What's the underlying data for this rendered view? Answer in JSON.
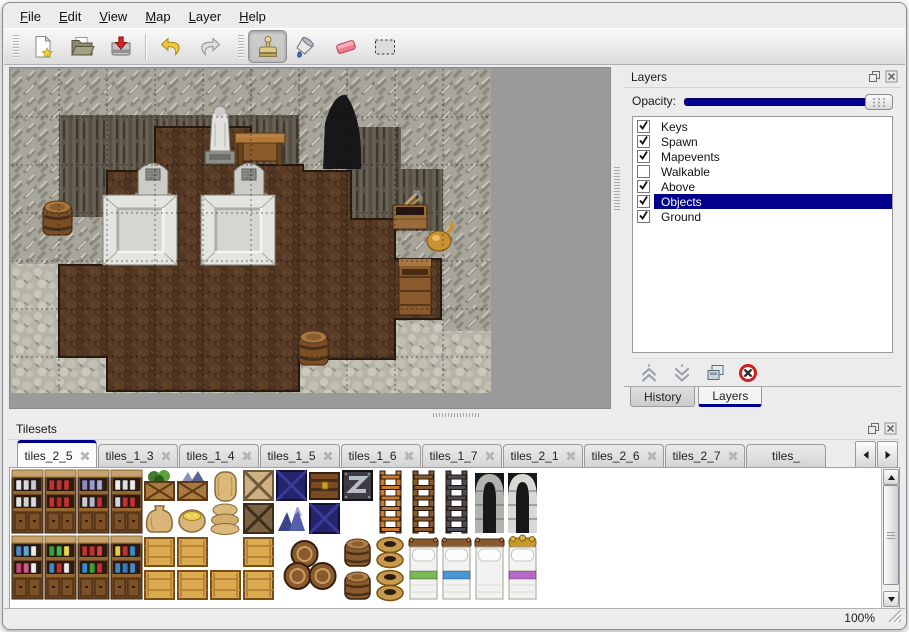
{
  "menu": {
    "items": [
      {
        "label": "File",
        "mnemonic": 0
      },
      {
        "label": "Edit",
        "mnemonic": 0
      },
      {
        "label": "View",
        "mnemonic": 0
      },
      {
        "label": "Map",
        "mnemonic": 0
      },
      {
        "label": "Layer",
        "mnemonic": 0
      },
      {
        "label": "Help",
        "mnemonic": 0
      }
    ]
  },
  "toolbar": {
    "tools": [
      {
        "name": "new-file",
        "active": false
      },
      {
        "name": "open",
        "active": false
      },
      {
        "name": "save",
        "active": false
      },
      {
        "name": "sep",
        "active": false
      },
      {
        "name": "undo",
        "active": false
      },
      {
        "name": "redo",
        "active": false
      },
      {
        "name": "grip",
        "active": false
      },
      {
        "name": "stamp",
        "active": true
      },
      {
        "name": "fill",
        "active": false
      },
      {
        "name": "eraser",
        "active": false
      },
      {
        "name": "select-rect",
        "active": false
      }
    ]
  },
  "layers_panel": {
    "title": "Layers",
    "opacity_label": "Opacity:",
    "layers": [
      {
        "name": "Keys",
        "checked": true,
        "selected": false
      },
      {
        "name": "Spawn",
        "checked": true,
        "selected": false
      },
      {
        "name": "Mapevents",
        "checked": true,
        "selected": false
      },
      {
        "name": "Walkable",
        "checked": false,
        "selected": false
      },
      {
        "name": "Above",
        "checked": true,
        "selected": false
      },
      {
        "name": "Objects",
        "checked": true,
        "selected": true
      },
      {
        "name": "Ground",
        "checked": true,
        "selected": false
      }
    ],
    "buttons": [
      "raise-layer",
      "lower-layer",
      "duplicate-layer",
      "delete-layer"
    ],
    "tabs": [
      {
        "label": "History",
        "active": false
      },
      {
        "label": "Layers",
        "active": true
      }
    ]
  },
  "tilesets_panel": {
    "title": "Tilesets",
    "tabs": [
      {
        "label": "tiles_2_5",
        "active": true
      },
      {
        "label": "tiles_1_3",
        "active": false
      },
      {
        "label": "tiles_1_4",
        "active": false
      },
      {
        "label": "tiles_1_5",
        "active": false
      },
      {
        "label": "tiles_1_6",
        "active": false
      },
      {
        "label": "tiles_1_7",
        "active": false
      },
      {
        "label": "tiles_2_1",
        "active": false
      },
      {
        "label": "tiles_2_6",
        "active": false
      },
      {
        "label": "tiles_2_7",
        "active": false
      },
      {
        "label": "tiles_",
        "active": false,
        "partial": true
      }
    ],
    "tiles": [
      {
        "t": "shelf",
        "c": 0,
        "r": 0,
        "top": [
          "#e6e6ea",
          "#d8d8e4",
          "#c9c9da"
        ],
        "bot": [
          "#e2e2e2",
          "#cfcfcf",
          "#dadae4"
        ]
      },
      {
        "t": "shelf",
        "c": 1,
        "r": 0,
        "top": [
          "#c23232",
          "#c23232",
          "#c23232"
        ],
        "bot": [
          "#c23232",
          "#b22a2a",
          "#c23232"
        ]
      },
      {
        "t": "shelf",
        "c": 2,
        "r": 0,
        "top": [
          "#8a8ac4",
          "#9a9ad2",
          "#aaaadc"
        ],
        "bot": [
          "#cacade",
          "#b8b8cc",
          "#c23232"
        ]
      },
      {
        "t": "shelf",
        "c": 3,
        "r": 0,
        "top": [
          "#ececec",
          "#dcdcdc",
          "#ececec"
        ],
        "bot": [
          "#d2d2e4",
          "#c23232",
          "#c23232"
        ]
      },
      {
        "t": "crate_plant",
        "c": 4,
        "r": 0
      },
      {
        "t": "crate_ore",
        "c": 5,
        "r": 0
      },
      {
        "t": "sack_tall",
        "c": 6,
        "r": 0
      },
      {
        "t": "cratex",
        "c": 7,
        "r": 0,
        "v": "light"
      },
      {
        "t": "crate_blue",
        "c": 8,
        "r": 0
      },
      {
        "t": "chest",
        "c": 9,
        "r": 0
      },
      {
        "t": "crate_metal",
        "c": 10,
        "r": 0
      },
      {
        "t": "ladder",
        "c": 11,
        "r": 0,
        "v": "#c87c32"
      },
      {
        "t": "ladder",
        "c": 12,
        "r": 0,
        "v": "#8a5a2a"
      },
      {
        "t": "ladder",
        "c": 13,
        "r": 0,
        "v": "#4c4c56"
      },
      {
        "t": "arch",
        "c": 14,
        "r": 0,
        "v": "#b2b2ae"
      },
      {
        "t": "arch",
        "c": 15,
        "r": 0,
        "v": "#d8d8d4"
      },
      {
        "t": "sack",
        "c": 4,
        "r": 1
      },
      {
        "t": "sack_open",
        "c": 5,
        "r": 1
      },
      {
        "t": "sack_stack",
        "c": 6,
        "r": 1
      },
      {
        "t": "cratex",
        "c": 7,
        "r": 1,
        "v": "dark"
      },
      {
        "t": "ore_blue",
        "c": 8,
        "r": 1
      },
      {
        "t": "crate_blue",
        "c": 9,
        "r": 1
      },
      {
        "t": "shelf",
        "c": 0,
        "r": 2,
        "top": [
          "#4a8aca",
          "#5aaada",
          "#ececec"
        ],
        "bot": [
          "#c24a7a",
          "#d25a8a",
          "#ececec"
        ]
      },
      {
        "t": "shelf",
        "c": 1,
        "r": 2,
        "top": [
          "#3aa23a",
          "#4ab24a",
          "#ead94a"
        ],
        "bot": [
          "#3a8aca",
          "#c23232",
          "#ececec"
        ]
      },
      {
        "t": "shelf",
        "c": 2,
        "r": 2,
        "top": [
          "#c23232",
          "#c23232",
          "#da4242"
        ],
        "bot": [
          "#3a8aca",
          "#3aa23a",
          "#c23232"
        ]
      },
      {
        "t": "shelf",
        "c": 3,
        "r": 2,
        "top": [
          "#eaca3a",
          "#c23232",
          "#3a8aca"
        ],
        "bot": [
          "#3a8aca",
          "#3a7aba",
          "#4a8aca"
        ]
      },
      {
        "t": "crate_y",
        "c": 4,
        "r": 2
      },
      {
        "t": "crate_y",
        "c": 5,
        "r": 2
      },
      {
        "t": "crate_y",
        "c": 7,
        "r": 2
      },
      {
        "t": "crate_y",
        "c": 4,
        "r": 3
      },
      {
        "t": "crate_y",
        "c": 5,
        "r": 3
      },
      {
        "t": "crate_y",
        "c": 6,
        "r": 3
      },
      {
        "t": "crate_y",
        "c": 7,
        "r": 3
      },
      {
        "t": "barrels3",
        "c": 8.35,
        "r": 2.15
      },
      {
        "t": "barrel_t",
        "c": 10,
        "r": 2
      },
      {
        "t": "barrel_t",
        "c": 10,
        "r": 3
      },
      {
        "t": "pots",
        "c": 11,
        "r": 2
      },
      {
        "t": "pots",
        "c": 11,
        "r": 3
      },
      {
        "t": "bed",
        "c": 12,
        "r": 2,
        "pillow": "#7ab858",
        "head": "wood"
      },
      {
        "t": "bed",
        "c": 13,
        "r": 2,
        "pillow": "#4898d8",
        "head": "wood"
      },
      {
        "t": "bed",
        "c": 14,
        "r": 2,
        "pillow": "",
        "head": "wood"
      },
      {
        "t": "bed",
        "c": 15,
        "r": 2,
        "pillow": "#b868c8",
        "head": "gold"
      }
    ]
  },
  "map": {
    "tile": 48,
    "w": 480,
    "h": 324,
    "grey": [
      [
        0,
        195,
        52,
        129
      ],
      [
        52,
        258,
        46,
        66
      ],
      [
        0,
        290,
        224,
        34
      ],
      [
        282,
        252,
        150,
        72
      ],
      [
        430,
        262,
        50,
        62
      ],
      [
        282,
        292,
        198,
        32
      ]
    ],
    "dark": [
      [
        48,
        46,
        96,
        102
      ],
      [
        144,
        46,
        96,
        50
      ],
      [
        240,
        46,
        48,
        52
      ],
      [
        336,
        58,
        54,
        104
      ],
      [
        388,
        100,
        44,
        62
      ]
    ],
    "floor": "144,58 240,58 240,96 292,96 292,102 340,102 340,150 384,150 384,190 430,190 430,250 384,250 384,290 288,290 288,322 96,322 96,288 48,288 48,196 96,196 96,102 144,102",
    "cave": {
      "x": 312,
      "y": 24,
      "w": 42,
      "h": 76
    },
    "objects": [
      {
        "t": "statue",
        "x": 192,
        "y": 30
      },
      {
        "t": "table",
        "x": 224,
        "y": 60
      },
      {
        "t": "grave",
        "x": 124,
        "y": 88
      },
      {
        "t": "grave",
        "x": 220,
        "y": 88
      },
      {
        "t": "platform",
        "x": 92,
        "y": 126
      },
      {
        "t": "platform",
        "x": 190,
        "y": 126
      },
      {
        "t": "barrel",
        "x": 30,
        "y": 128
      },
      {
        "t": "crate_tools",
        "x": 380,
        "y": 120
      },
      {
        "t": "pot_gold",
        "x": 414,
        "y": 152
      },
      {
        "t": "cabinet",
        "x": 386,
        "y": 188
      },
      {
        "t": "barrel",
        "x": 286,
        "y": 258
      }
    ]
  },
  "statusbar": {
    "zoom": "100%"
  },
  "colors": {
    "selection": "#00008c",
    "accent": "#00008c"
  }
}
